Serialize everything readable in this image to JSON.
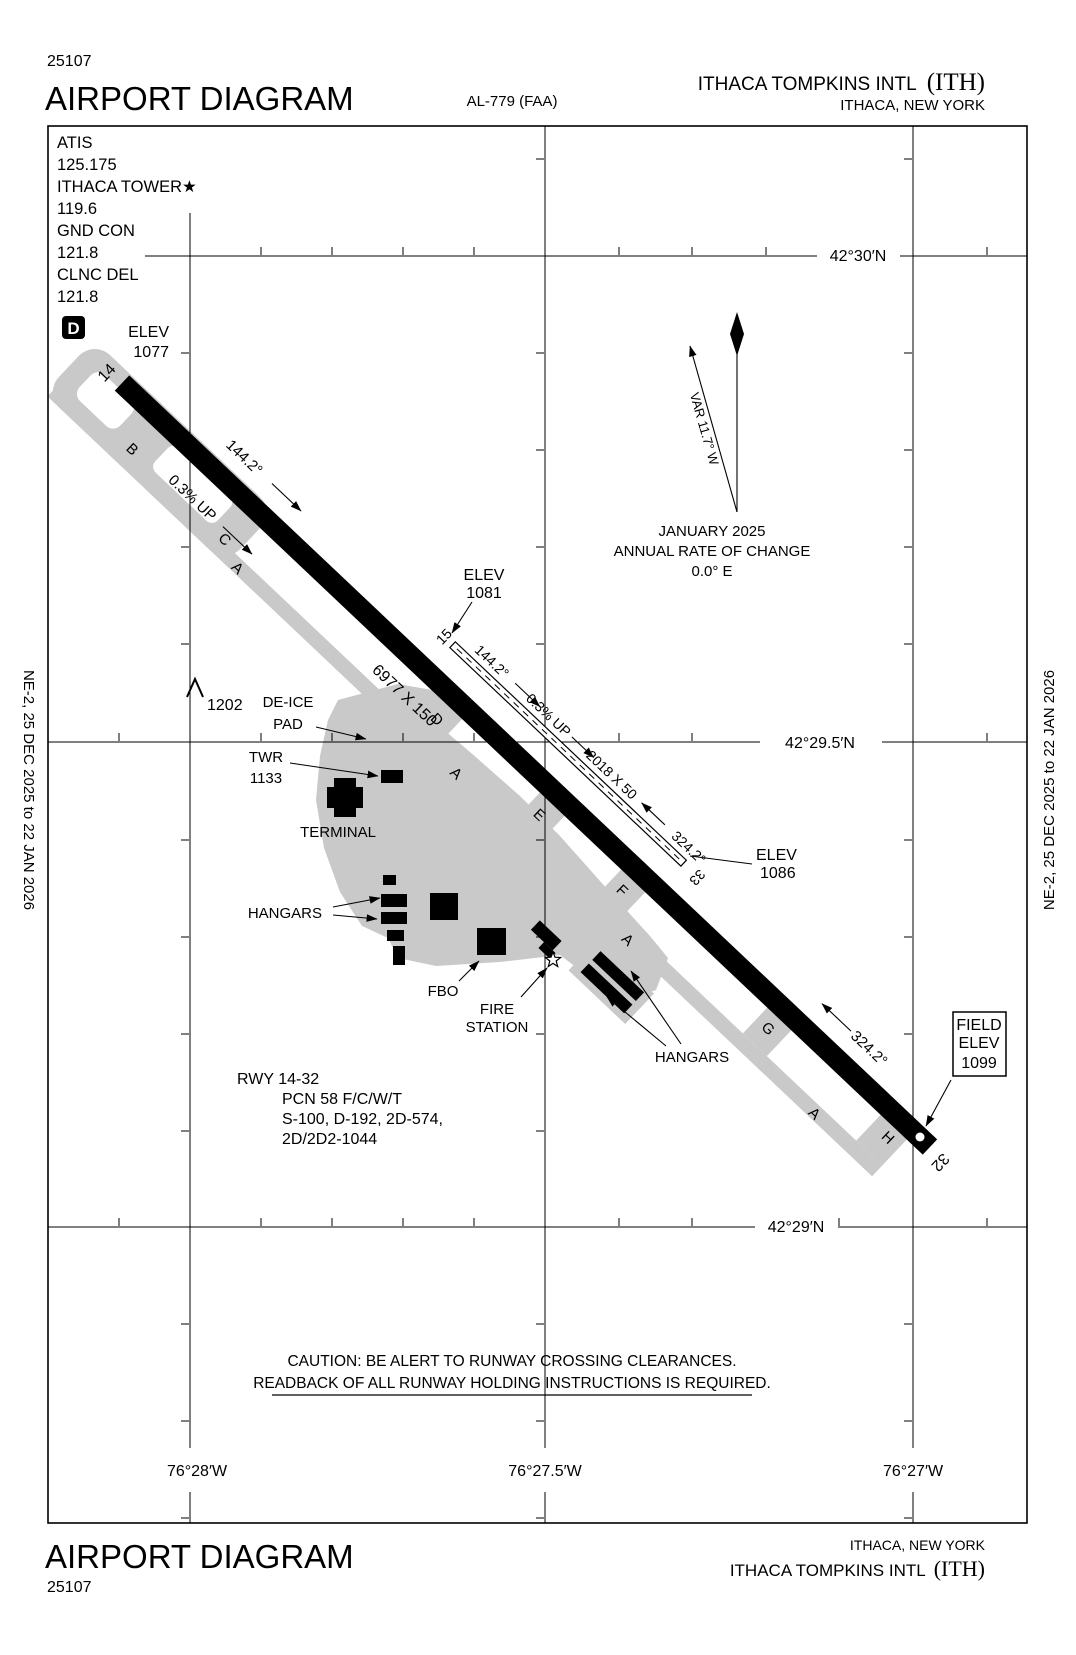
{
  "header": {
    "chart_id": "25107",
    "title": "AIRPORT DIAGRAM",
    "procedure_id": "AL-779 (FAA)",
    "airport_name": "ITHACA TOMPKINS INTL",
    "airport_code": "(ITH)",
    "city_state": "ITHACA, NEW YORK"
  },
  "footer": {
    "title": "AIRPORT DIAGRAM",
    "chart_id": "25107",
    "city_state": "ITHACA, NEW YORK",
    "airport_name": "ITHACA TOMPKINS INTL",
    "airport_code": "(ITH)"
  },
  "side_banner": "NE-2,  25 DEC 2025  to  22 JAN 2026",
  "comms": {
    "atis_label": "ATIS",
    "atis_freq": "125.175",
    "tower_label": "ITHACA TOWER★",
    "tower_freq": "119.6",
    "ground_label": "GND CON",
    "ground_freq": "121.8",
    "clearance_label": "CLNC DEL",
    "clearance_freq": "121.8",
    "d_symbol": "D"
  },
  "grid": {
    "latitudes": [
      "42°30′N",
      "42°29.5′N",
      "42°29′N"
    ],
    "longitudes": [
      "76°28′W",
      "76°27.5′W",
      "76°27′W"
    ]
  },
  "variation": {
    "label": "VAR 11.7° W",
    "date": "JANUARY 2025",
    "change_line1": "ANNUAL RATE OF CHANGE",
    "change_line2": "0.0° E"
  },
  "runway_14_32": {
    "end14": "14",
    "end32": "32",
    "dimensions": "6977 X 150",
    "heading14": "144.2°",
    "heading32": "324.2°",
    "slope": "0.3% UP",
    "elev14_label": "ELEV",
    "elev14": "1077"
  },
  "runway_15_33": {
    "end15": "15",
    "end33": "33",
    "dimensions": "2018 X 50",
    "heading15": "144.2°",
    "heading33": "324.2°",
    "slope": "0.3% UP",
    "elev15_label": "ELEV",
    "elev15": "1081",
    "elev33_label": "ELEV",
    "elev33": "1086"
  },
  "field_elevation": {
    "line1": "FIELD",
    "line2": "ELEV",
    "value": "1099"
  },
  "obstruction": "1202",
  "facilities": {
    "deice_line1": "DE-ICE",
    "deice_line2": "PAD",
    "tower_line1": "TWR",
    "tower_line2": "1133",
    "terminal": "TERMINAL",
    "hangars_west": "HANGARS",
    "hangars_southeast": "HANGARS",
    "fbo": "FBO",
    "fire_line1": "FIRE",
    "fire_line2": "STATION"
  },
  "taxiway_labels": [
    {
      "t": "B"
    },
    {
      "t": "C"
    },
    {
      "t": "A"
    },
    {
      "t": "D"
    },
    {
      "t": "A"
    },
    {
      "t": "E"
    },
    {
      "t": "F"
    },
    {
      "t": "A"
    },
    {
      "t": "G"
    },
    {
      "t": "A"
    },
    {
      "t": "H"
    }
  ],
  "runway_data": {
    "line1": "RWY 14-32",
    "line2": "PCN 58 F/C/W/T",
    "line3": "S-100, D-192, 2D-574,",
    "line4": "2D/2D2-1044"
  },
  "caution": {
    "line1": "CAUTION:  BE ALERT TO RUNWAY CROSSING CLEARANCES.",
    "line2": "READBACK OF ALL RUNWAY HOLDING INSTRUCTIONS IS REQUIRED."
  },
  "colors": {
    "ink": "#000000",
    "taxiway_gray": "#c9c9c9",
    "paper": "#ffffff"
  }
}
